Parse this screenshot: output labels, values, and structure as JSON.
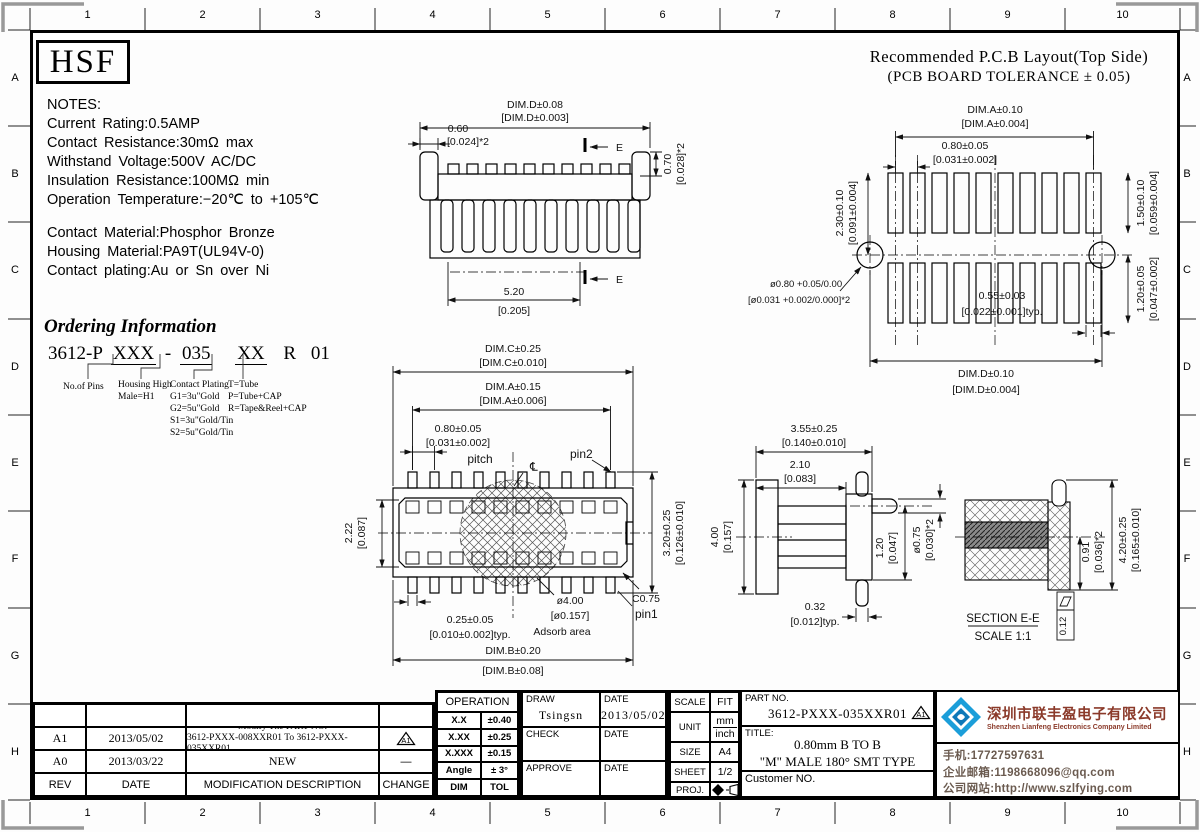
{
  "colors": {
    "line": "#000000",
    "accent_logo_blue": "#1b9ed9",
    "accent_logo_dark_blue": "#0e78b8",
    "company_name_red": "#8b3a2a",
    "company_text_brown": "#6b5b50"
  },
  "sheet": {
    "logo_text": "HSF",
    "top_ruler": [
      "1",
      "2",
      "3",
      "4",
      "5",
      "6",
      "7",
      "8",
      "9",
      "10"
    ],
    "bottom_ruler": [
      "1",
      "2",
      "3",
      "4",
      "5",
      "6",
      "7",
      "8",
      "9",
      "10"
    ],
    "left_ruler": [
      "A",
      "B",
      "C",
      "D",
      "E",
      "F",
      "G",
      "H"
    ],
    "right_ruler": [
      "A",
      "B",
      "C",
      "D",
      "E",
      "F",
      "G",
      "H"
    ]
  },
  "notes": {
    "title": "NOTES:",
    "lines1": [
      "Current Rating:0.5AMP",
      "Contact Resistance:30mΩ max",
      "Withstand Voltage:500V AC/DC",
      "Insulation Resistance:100MΩ min",
      "Operation Temperature:−20℃ to +105℃"
    ],
    "lines2": [
      "Contact Material:Phosphor Bronze",
      "Housing Material:PA9T(UL94V-0)",
      "Contact plating:Au or Sn over Ni"
    ]
  },
  "ordering": {
    "title": "Ordering Information",
    "part_prefix": "3612-P",
    "seg_pins": "XXX",
    "dash": "-",
    "seg_height": "035",
    "seg_plating": "XX",
    "seg_package": "R",
    "seg_suffix": "01",
    "label_pins": "No.of Pins",
    "label_housing_line1": "Housing High",
    "label_housing_line2": "Male=H1",
    "label_plating_title": "Contact Plating",
    "plating_options": [
      "G1=3u\"Gold",
      "G2=5u\"Gold",
      "S1=3u\"Gold/Tin",
      "S2=5u\"Gold/Tin"
    ],
    "package_options": [
      "T=Tube",
      "P=Tube+CAP",
      "R=Tape&Reel+CAP"
    ]
  },
  "pcb_layout": {
    "title_line1": "Recommended P.C.B Layout(Top Side)",
    "title_line2": "(PCB BOARD TOLERANCE ± 0.05)",
    "dim_a_mm": "DIM.A±0.10",
    "dim_a_in": "[DIM.A±0.004]",
    "pitch_mm": "0.80±0.05",
    "pitch_in": "[0.031±0.002]",
    "row_height_mm": "2.30±0.10",
    "row_height_in": "[0.091±0.004]",
    "pad_height_mm": "1.50±0.10",
    "pad_height_in": "[0.059±0.004]",
    "hole_mm": "ø0.80 +0.05/0.00",
    "hole_in": "[ø0.031 +0.002/0.000]*2",
    "pad_width_mm": "0.55±0.03",
    "pad_width_in": "[0.022±0.001]typ.",
    "lower_row_mm": "1.20±0.05",
    "lower_row_in": "[0.047±0.002]",
    "dim_d_mm": "DIM.D±0.10",
    "dim_d_in": "[DIM.D±0.004]"
  },
  "front_view": {
    "dim_d_mm": "DIM.D±0.08",
    "dim_d_in": "[DIM.D±0.003]",
    "end_mm": "0.60",
    "end_in": "[0.024]*2",
    "tab_mm": "0.70",
    "tab_in": "[0.028]*2",
    "span_mm": "5.20",
    "span_in": "[0.205]",
    "section_mark": "E"
  },
  "top_view": {
    "dim_c_mm": "DIM.C±0.25",
    "dim_c_in": "[DIM.C±0.010]",
    "dim_a_mm": "DIM.A±0.15",
    "dim_a_in": "[DIM.A±0.006]",
    "pitch_mm": "0.80±0.05",
    "pitch_in": "[0.031±0.002]",
    "pitch_label": "pitch",
    "centerline_mark": "℄",
    "pin2_label": "pin2",
    "depth_mm": "2.22",
    "depth_in": "[0.087]",
    "height_mm": "3.20±0.25",
    "height_in": "[0.126±0.010]",
    "pin_width_mm": "0.25±0.05",
    "pin_width_in": "[0.010±0.002]typ.",
    "adsorb_mm": "ø4.00",
    "adsorb_in": "[ø0.157]",
    "adsorb_label": "Adsorb area",
    "chamfer": "C0.75",
    "pin1_label": "pin1",
    "dim_b_mm": "DIM.B±0.20",
    "dim_b_in": "[DIM.B±0.08]"
  },
  "side_view": {
    "width_mm": "3.55±0.25",
    "width_in": "[0.140±0.010]",
    "body_mm": "2.10",
    "body_in": "[0.083]",
    "height_mm": "4.00",
    "height_in": "[0.157]",
    "pin_len_mm": "1.20",
    "pin_len_in": "[0.047]",
    "pin_dia_mm": "ø0.75",
    "pin_dia_in": "[0.030]*2",
    "foot_mm": "0.32",
    "foot_in": "[0.012]typ."
  },
  "section_view": {
    "slot_mm": "0.91",
    "slot_in": "[0.036]*2",
    "total_mm": "4.20±0.25",
    "total_in": "[0.165±0.010]",
    "label": "SECTION E-E",
    "scale": "SCALE 1:1",
    "flatness": "0.12"
  },
  "title_block": {
    "revisions": [
      {
        "rev": "A1",
        "date": "2013/05/02",
        "desc_line1": "Modify The PART NO.",
        "desc_line2": "3612-PXXX-008XXR01 To 3612-PXXX-035XXR01",
        "change": "A1"
      },
      {
        "rev": "A0",
        "date": "2013/03/22",
        "desc_line1": "NEW",
        "desc_line2": "",
        "change": "—"
      }
    ],
    "rev_header": {
      "rev": "REV",
      "date": "DATE",
      "desc": "MODIFICATION DESCRIPTION",
      "change": "CHANGE"
    },
    "operation": {
      "title": "OPERATION",
      "rows": [
        [
          "X.X",
          "±0.40"
        ],
        [
          "X.XX",
          "±0.25"
        ],
        [
          "X.XXX",
          "±0.15"
        ],
        [
          "Angle",
          "± 3°"
        ],
        [
          "DIM",
          "TOL"
        ]
      ]
    },
    "sign": {
      "draw_label": "DRAW",
      "draw_value": "Tsingsn",
      "date1_label": "DATE",
      "date1_value": "2013/05/02",
      "check_label": "CHECK",
      "date2_label": "DATE",
      "approve_label": "APPROVE",
      "date3_label": "DATE"
    },
    "meta": {
      "scale_label": "SCALE",
      "scale_value": "FIT",
      "unit_label": "UNIT",
      "unit_top": "mm",
      "unit_bottom": "inch",
      "size_label": "SIZE",
      "size_value": "A4",
      "sheet_label": "SHEET",
      "sheet_value": "1/2",
      "proj_label": "PROJ."
    },
    "part": {
      "part_no_label": "PART NO.",
      "part_no_value": "3612-PXXX-035XXR01",
      "change_mark": "A1",
      "title_label": "TITLE:",
      "title_line1": "0.80mm B TO B",
      "title_line2": "\"M\" MALE 180° SMT TYPE",
      "customer_label": "Customer NO."
    },
    "company": {
      "name_cn": "深圳市联丰盈电子有限公司",
      "name_en": "Shenzhen Lianfeng Electronics Company Limited",
      "phone": "手机:17727597631",
      "email": "企业邮箱:1198668096@qq.com",
      "website": "公司网站:http://www.szlfying.com"
    }
  }
}
